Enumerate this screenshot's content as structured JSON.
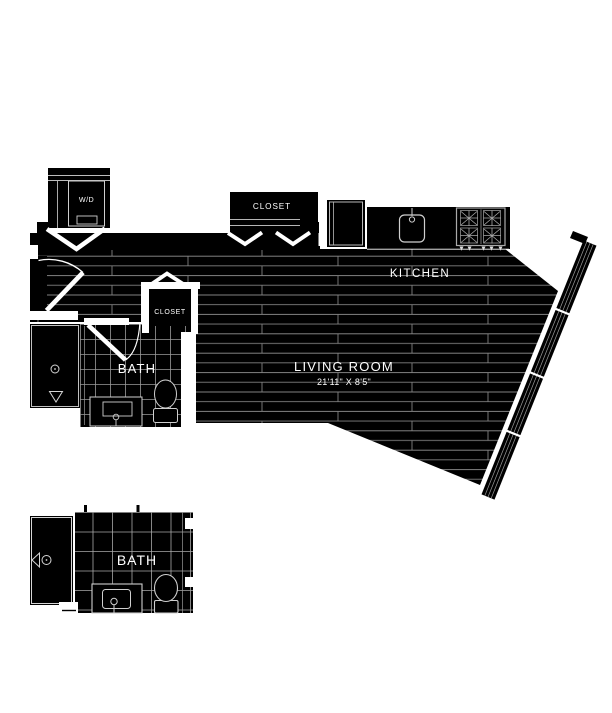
{
  "plan": {
    "type": "apartment-floor-plan",
    "background_color": "#ffffff",
    "wall_fill_color": "#000000",
    "plank_line_color": "#828282",
    "tile_line_color": "#9a9a9a",
    "label_color": "#ffffff",
    "labels": {
      "laundry": "W/D",
      "closet_top": "CLOSET",
      "closet_hall": "CLOSET",
      "kitchen": "KITCHEN",
      "living_room": "LIVING ROOM",
      "living_room_dim": "21'11\" X 8'5\"",
      "bath": "BATH",
      "bath_detail": "BATH"
    },
    "fixtures": [
      "washer-dryer",
      "bifold-closet-doors",
      "refrigerator",
      "kitchen-sink",
      "stove-4-burner",
      "entry-door",
      "bath-door",
      "shower",
      "vanity-sink",
      "toilet",
      "angled-window-wall"
    ]
  }
}
